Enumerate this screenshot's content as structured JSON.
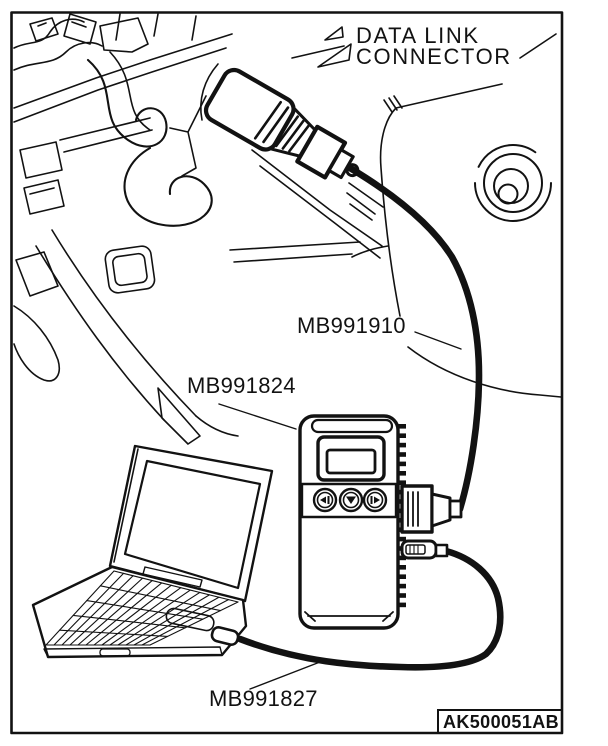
{
  "figure": {
    "description": "Scan tool connection diagram: V.C.I. connected between vehicle data link connector and personal computer",
    "title_line1": "DATA LINK",
    "title_line2": "CONNECTOR",
    "code": "AK500051AB"
  },
  "parts": {
    "harness_cable": "MB991910",
    "vci": "MB991824",
    "usb_cable": "MB991827"
  },
  "colors": {
    "ink": "#121212",
    "paper": "#ffffff"
  }
}
